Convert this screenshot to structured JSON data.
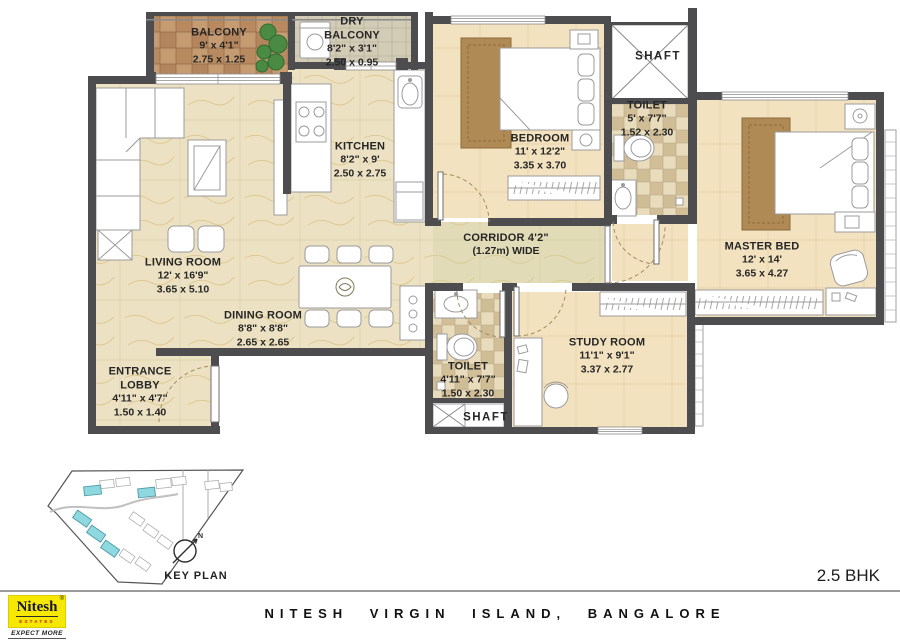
{
  "title_block": {
    "unit_type": "2.5 BHK",
    "project": "NITESH VIRGIN ISLAND, BANGALORE"
  },
  "logo": {
    "brand": "Nitesh",
    "brand_sub": "ESTATES",
    "tagline": "EXPECT MORE",
    "reg_mark": "®"
  },
  "key_plan": {
    "label": "KEY PLAN",
    "north_label": "N"
  },
  "rooms": {
    "balcony": {
      "name": "BALCONY",
      "imperial": "9' x 4'1\"",
      "metric": "2.75 x 1.25"
    },
    "dry_balcony": {
      "name": "DRY BALCONY",
      "imperial": "8'2\" x 3'1\"",
      "metric": "2.50 x 0.95"
    },
    "kitchen": {
      "name": "KITCHEN",
      "imperial": "8'2\" x 9'",
      "metric": "2.50 x 2.75"
    },
    "bedroom": {
      "name": "BEDROOM",
      "imperial": "11' x 12'2\"",
      "metric": "3.35 x 3.70"
    },
    "shaft_top": {
      "name": "SHAFT"
    },
    "toilet_top": {
      "name": "TOILET",
      "imperial": "5' x 7'7\"",
      "metric": "1.52 x 2.30"
    },
    "master_bed": {
      "name": "MASTER BED",
      "imperial": "12' x 14'",
      "metric": "3.65 x 4.27"
    },
    "corridor": {
      "name": "CORRIDOR 4'2\"",
      "sub": "(1.27m) WIDE"
    },
    "living_room": {
      "name": "LIVING ROOM",
      "imperial": "12' x 16'9\"",
      "metric": "3.65 x 5.10"
    },
    "dining_room": {
      "name": "DINING ROOM",
      "imperial": "8'8\" x 8'8\"",
      "metric": "2.65 x 2.65"
    },
    "entrance_lobby": {
      "name": "ENTRANCE LOBBY",
      "imperial": "4'11\" x 4'7\"",
      "metric": "1.50 x 1.40"
    },
    "toilet_bottom": {
      "name": "TOILET",
      "imperial": "4'11\" x 7'7\"",
      "metric": "1.50 x 2.30"
    },
    "study_room": {
      "name": "STUDY ROOM",
      "imperial": "11'1\" x 9'1\"",
      "metric": "3.37 x 2.77"
    },
    "shaft_bottom": {
      "name": "SHAFT"
    }
  },
  "colors": {
    "wall": "#4d4d4f",
    "floor_marble": "#ece2c3",
    "floor_room_tan": "#f3e2bf",
    "balcony_tile": "#c59b72",
    "bath_tile": "#e9dcbc",
    "keyplan_highlight": "#8ed8e0",
    "logo_yellow": "#f6e800",
    "logo_red": "#c21f1f"
  }
}
